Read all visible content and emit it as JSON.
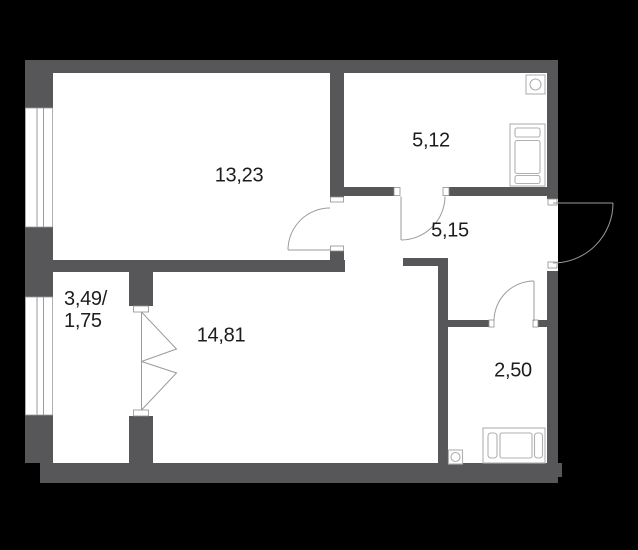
{
  "canvas": {
    "width": 638,
    "height": 550,
    "background": "#000000"
  },
  "palette": {
    "wall": "#57575a",
    "floor": "#ffffff",
    "door_window_line": "#9b9b9b",
    "fixture_line": "#b0b0b0",
    "label_text": "#1d1d1d"
  },
  "rooms": [
    {
      "name": "room-13-23",
      "area_label": "13,23"
    },
    {
      "name": "room-5-12",
      "area_label": "5,12"
    },
    {
      "name": "hallway-5-15",
      "area_label": "5,15"
    },
    {
      "name": "room-14-81",
      "area_label": "14,81"
    },
    {
      "name": "bathroom-2-50",
      "area_label": "2,50"
    },
    {
      "name": "balcony",
      "area_label_line1": "3,49/",
      "area_label_line2": "1,75"
    }
  ],
  "icons": [
    "window-icon",
    "balcony-window-icon",
    "french-door-icon",
    "interior-door-arc-icon",
    "entrance-door-arc-icon",
    "sink-icon",
    "stove-icon",
    "bathtub-icon",
    "washbasin-icon"
  ]
}
